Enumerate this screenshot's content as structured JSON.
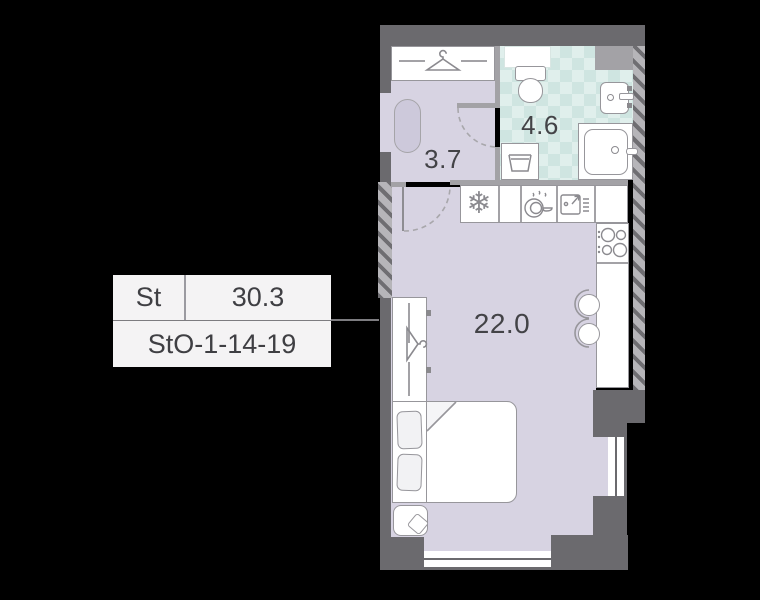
{
  "unit_card": {
    "type_label": "St",
    "area_label": "30.3",
    "code_label": "StO-1-14-19"
  },
  "rooms": {
    "hallway": {
      "name": "hallway",
      "area": "3.7"
    },
    "bathroom": {
      "name": "bathroom",
      "area": "4.6"
    },
    "living": {
      "name": "living-room",
      "area": "22.0"
    }
  },
  "glyphs": {
    "snowflake": "❄"
  },
  "palette": {
    "background": "#000000",
    "wall_dark": "#6b6a6e",
    "wall_partition": "#a3a2a6",
    "hatch_light": "#b6b5b9",
    "floor_lavender": "#d7d3e2",
    "bath_teal_base": "#e0efec",
    "bath_teal_check": "#cfe5e1",
    "fixture_white": "#ffffff",
    "fixture_border": "#97969b",
    "text": "#3f3f43",
    "card_bg": "#f4f3f4"
  }
}
